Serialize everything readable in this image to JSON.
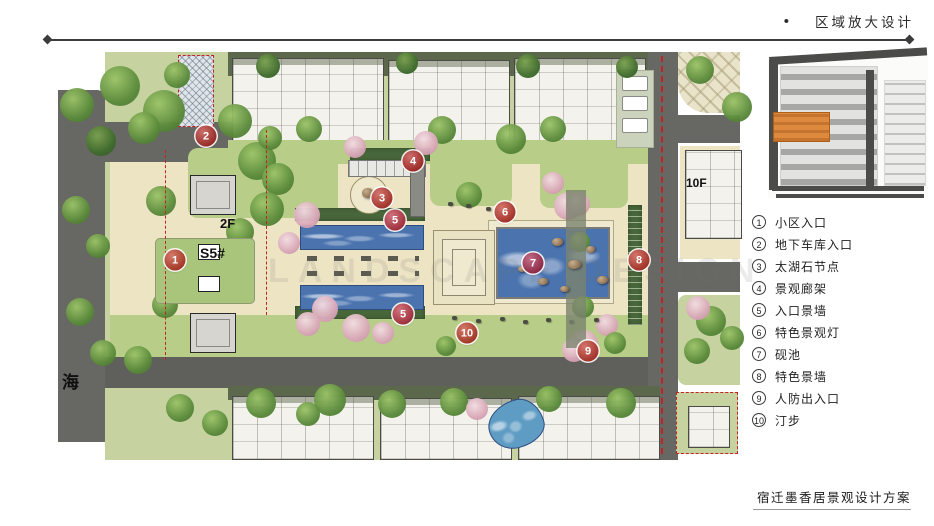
{
  "header": {
    "bullet": "•",
    "title": "区域放大设计"
  },
  "footer": {
    "title": "宿迁墨香居景观设计方案"
  },
  "plan": {
    "watermark": "LANDSCAPE DESIGN",
    "labels": [
      {
        "text": "2F",
        "x": 220,
        "y": 216,
        "size": 13
      },
      {
        "text": "S5#",
        "x": 200,
        "y": 245,
        "size": 14
      },
      {
        "text": "10F",
        "x": 686,
        "y": 176,
        "size": 12
      },
      {
        "text": "海",
        "x": 62,
        "y": 368,
        "size": 17
      }
    ],
    "markers": [
      {
        "num": "1",
        "x": 175,
        "y": 260,
        "color": "#c2402a"
      },
      {
        "num": "2",
        "x": 206,
        "y": 136,
        "color": "#b3302a"
      },
      {
        "num": "3",
        "x": 382,
        "y": 198,
        "color": "#c03a30"
      },
      {
        "num": "4",
        "x": 413,
        "y": 161,
        "color": "#b92f2b"
      },
      {
        "num": "5",
        "x": 395,
        "y": 220,
        "color": "#bd3644"
      },
      {
        "num": "5",
        "x": 403,
        "y": 314,
        "color": "#bd3644"
      },
      {
        "num": "6",
        "x": 505,
        "y": 212,
        "color": "#c23a2e"
      },
      {
        "num": "7",
        "x": 533,
        "y": 263,
        "color": "#a82e52"
      },
      {
        "num": "8",
        "x": 639,
        "y": 260,
        "color": "#c13a2c"
      },
      {
        "num": "9",
        "x": 588,
        "y": 351,
        "color": "#c23a2e"
      },
      {
        "num": "10",
        "x": 467,
        "y": 333,
        "color": "#c2402a"
      }
    ]
  },
  "keymap": {
    "highlight_color": "#dd8a3f"
  },
  "legend": {
    "items": [
      {
        "num": "1",
        "label": "小区入口"
      },
      {
        "num": "2",
        "label": "地下车库入口"
      },
      {
        "num": "3",
        "label": "太湖石节点"
      },
      {
        "num": "4",
        "label": "景观廊架"
      },
      {
        "num": "5",
        "label": "入口景墙"
      },
      {
        "num": "6",
        "label": "特色景观灯"
      },
      {
        "num": "7",
        "label": "砚池"
      },
      {
        "num": "8",
        "label": "特色景墙"
      },
      {
        "num": "9",
        "label": "人防出入口"
      },
      {
        "num": "10",
        "label": "汀步"
      }
    ]
  }
}
